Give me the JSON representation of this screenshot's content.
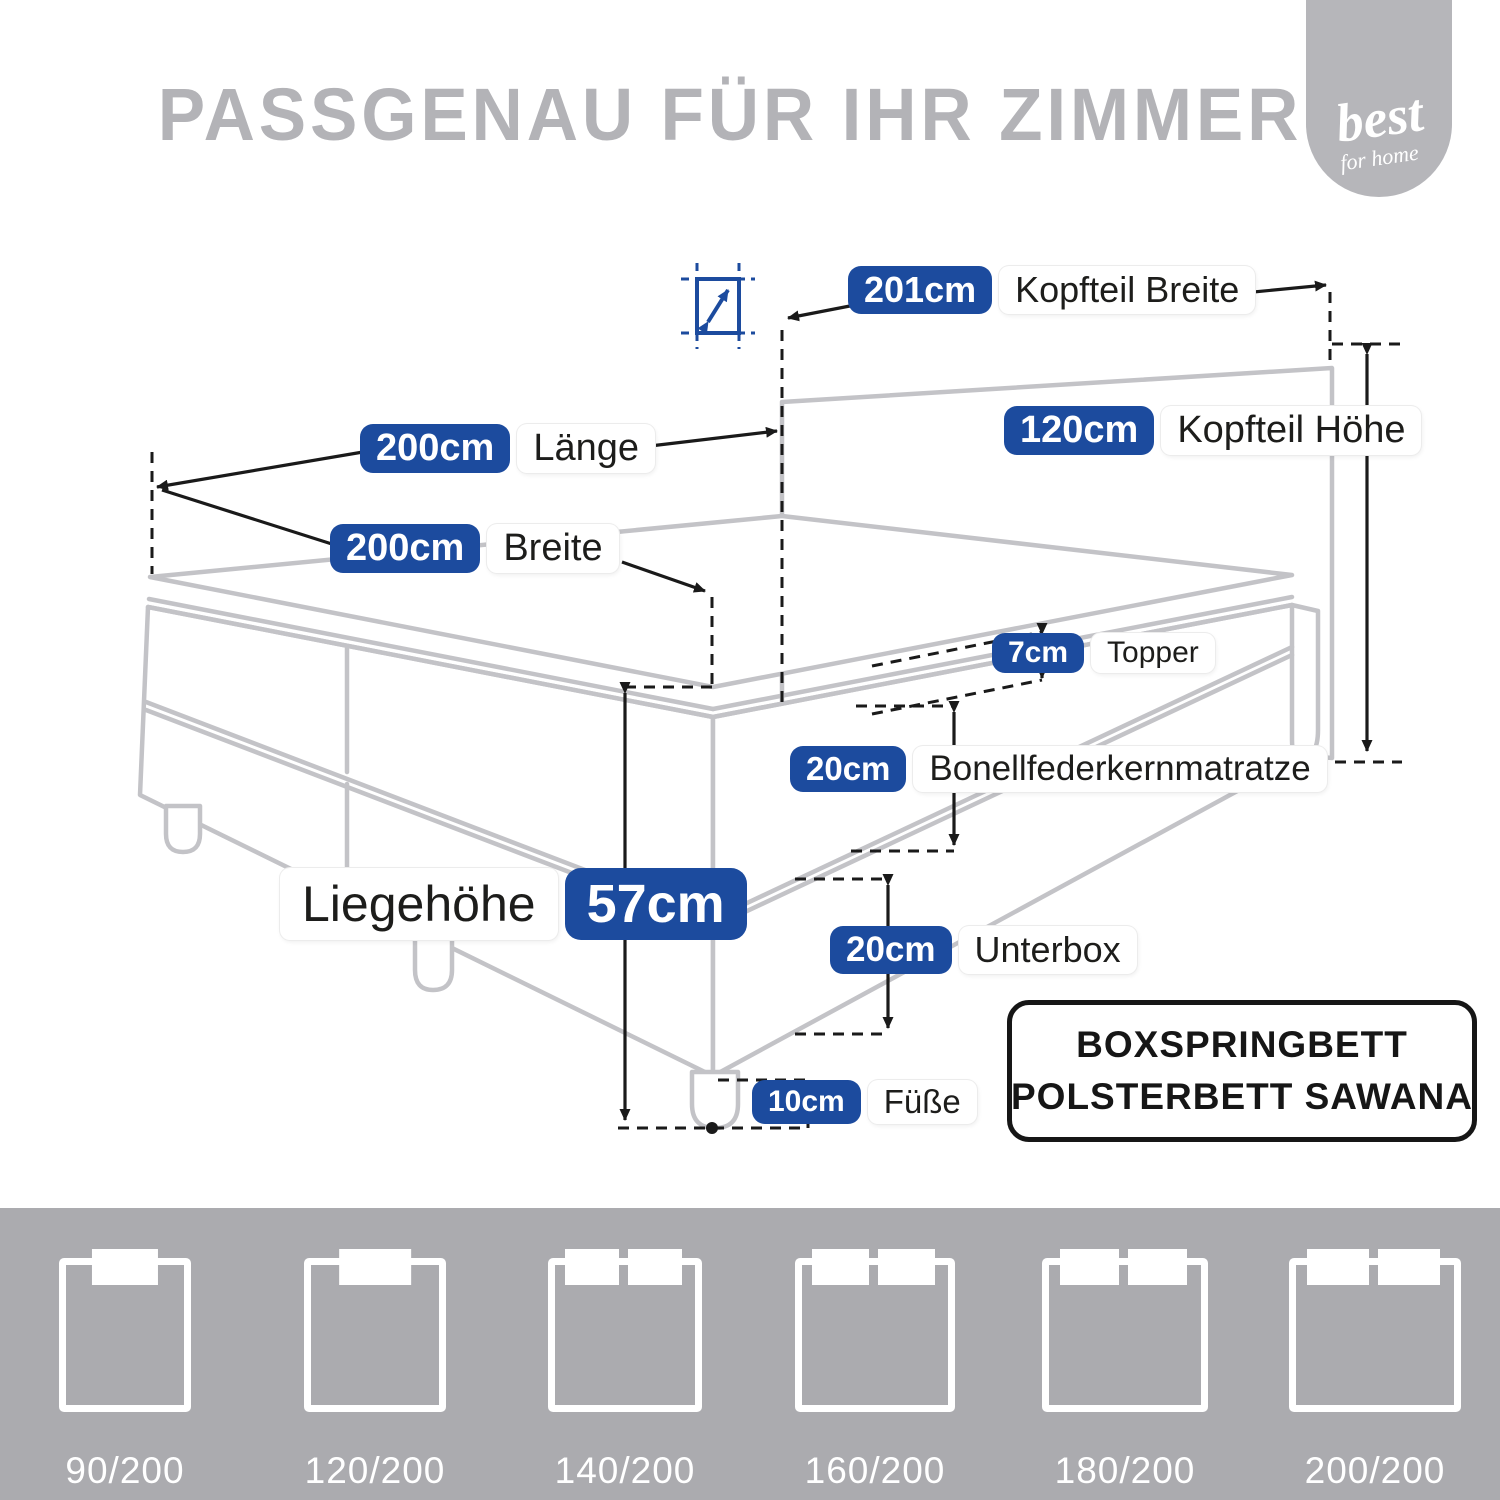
{
  "title": "PASSGENAU FÜR IHR ZIMMER",
  "logo": {
    "line1": "best",
    "line2": "for home"
  },
  "colors": {
    "accent_blue": "#1c4b9e",
    "title_gray": "#b3b3b7",
    "strip_gray": "#ababaf",
    "line_gray": "#c3c3c7",
    "dimension_black": "#1a1a1a"
  },
  "measurements": {
    "kopfteil_breite": {
      "value": "201cm",
      "label": "Kopfteil Breite"
    },
    "kopfteil_hoehe": {
      "value": "120cm",
      "label": "Kopfteil Höhe"
    },
    "laenge": {
      "value": "200cm",
      "label": "Länge"
    },
    "breite": {
      "value": "200cm",
      "label": "Breite"
    },
    "topper": {
      "value": "7cm",
      "label": "Topper"
    },
    "matratze": {
      "value": "20cm",
      "label": "Bonellfederkernmatratze"
    },
    "liegehoehe": {
      "label": "Liegehöhe",
      "value": "57cm"
    },
    "unterbox": {
      "value": "20cm",
      "label": "Unterbox"
    },
    "fuesse": {
      "value": "10cm",
      "label": "Füße"
    }
  },
  "product_box": {
    "line1": "BOXSPRINGBETT",
    "line2": "POLSTERBETT SAWANA"
  },
  "sizes": [
    {
      "label": "90/200",
      "pillows": 1
    },
    {
      "label": "120/200",
      "pillows": 1
    },
    {
      "label": "140/200",
      "pillows": 2
    },
    {
      "label": "160/200",
      "pillows": 2
    },
    {
      "label": "180/200",
      "pillows": 2
    },
    {
      "label": "200/200",
      "pillows": 2
    }
  ]
}
